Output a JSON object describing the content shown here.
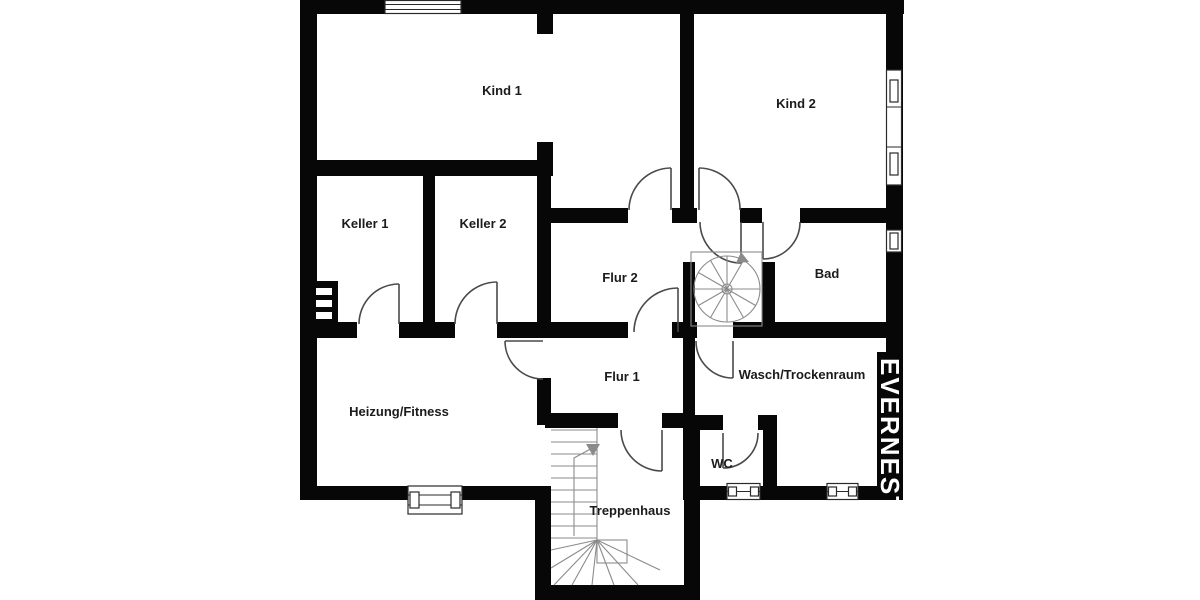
{
  "plan": {
    "type": "floor-plan",
    "rooms": [
      {
        "name": "Kind 1"
      },
      {
        "name": "Kind 2"
      },
      {
        "name": "Keller 1"
      },
      {
        "name": "Keller 2"
      },
      {
        "name": "Flur 2"
      },
      {
        "name": "Bad"
      },
      {
        "name": "Heizung/Fitness"
      },
      {
        "name": "Flur 1"
      },
      {
        "name": "Wasch/Trockenraum"
      },
      {
        "name": "WC"
      },
      {
        "name": "Treppenhaus"
      }
    ],
    "watermark": "EVERNEST",
    "colors": {
      "wall": "#070707",
      "background": "#ffffff",
      "door_arc": "#4a4a4a",
      "stair_line": "#8b8b8b",
      "label": "#1b1b1b",
      "window_frame": "#2a2a2a",
      "watermark_text": "#ffffff"
    }
  }
}
